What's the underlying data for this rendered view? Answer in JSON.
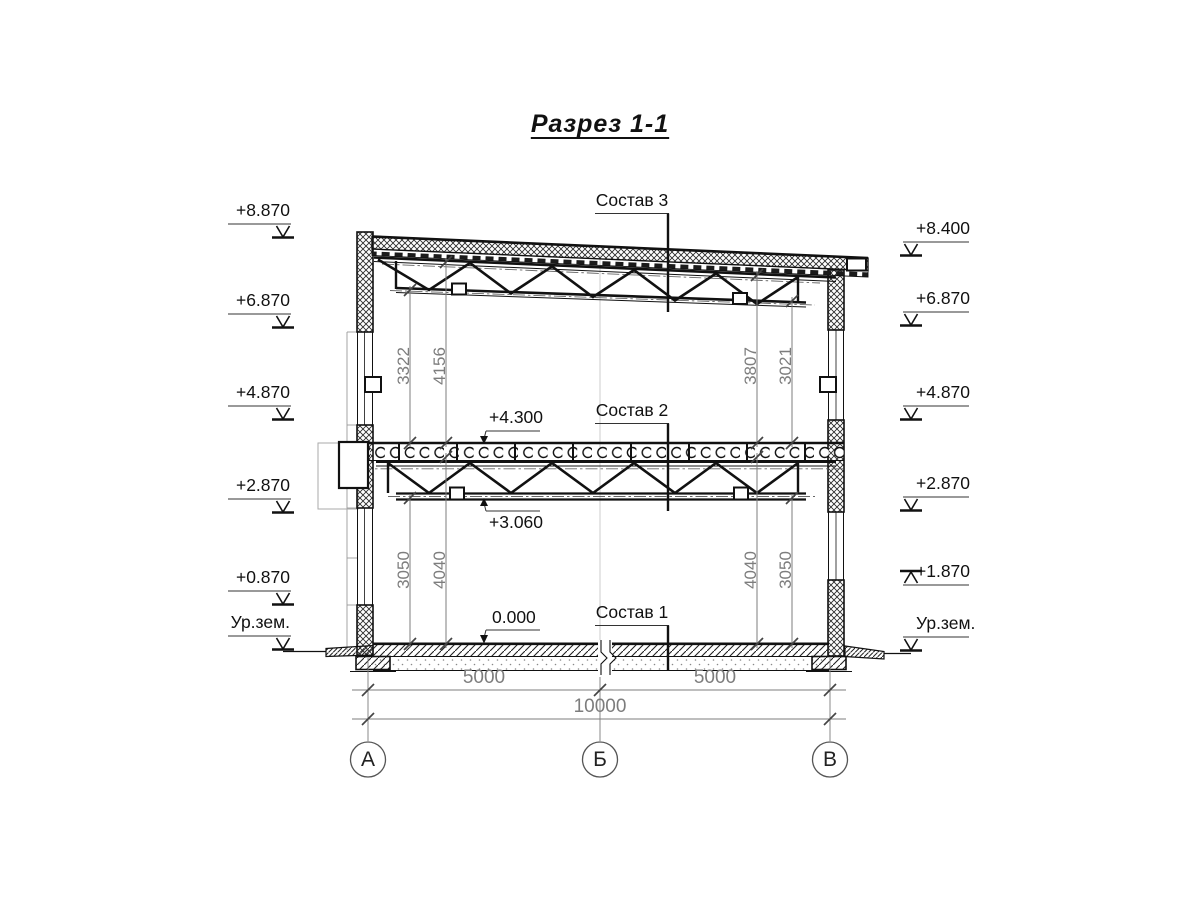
{
  "title": "Разрез 1-1",
  "composition_labels": {
    "c3": "Состав 3",
    "c2": "Состав 2",
    "c1": "Состав 1"
  },
  "level_labels": {
    "l4300": "+4.300",
    "l3060": "+3.060",
    "l0000": "0.000"
  },
  "elevations_left": [
    "+8.870",
    "+6.870",
    "+4.870",
    "+2.870",
    "+0.870",
    "Ур.зем."
  ],
  "elevations_right": [
    "+8.400",
    "+6.870",
    "+4.870",
    "+2.870",
    "+1.870",
    "Ур.зем."
  ],
  "vertical_dims": {
    "upper_left": [
      "3322",
      "4156"
    ],
    "upper_right": [
      "3807",
      "3021"
    ],
    "lower_left": [
      "3050",
      "4040"
    ],
    "lower_right": [
      "4040",
      "3050"
    ]
  },
  "horizontal_dims": {
    "span_ab": "5000",
    "span_bc": "5000",
    "total": "10000"
  },
  "axes": [
    "А",
    "Б",
    "В"
  ],
  "colors": {
    "line": "#111111",
    "dim": "#7d7d7d",
    "background": "#ffffff"
  }
}
